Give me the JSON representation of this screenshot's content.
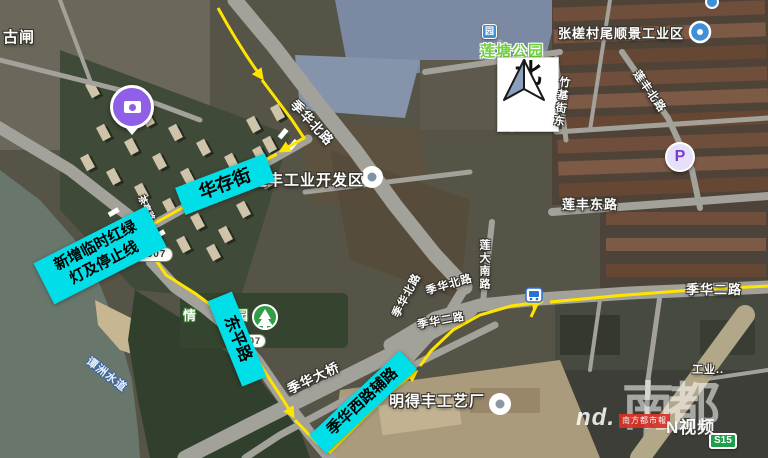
{
  "map_colors": {
    "annotation_bg": "#00dfe8",
    "route_yellow": "#ffe400"
  },
  "annotations": {
    "huacun": "华存街",
    "new_light_l1": "新增临时红绿",
    "new_light_l2": "灯及停止线",
    "dongping": "东平路",
    "jihua_west_aux": "季华西路辅路"
  },
  "roads": {
    "x507": "X507",
    "x507_b": "X507",
    "jihua_north_a": "季华北路",
    "jihua_north_b": "季华北路",
    "jihua_north_c": "季华北路",
    "jihua_second_a": "季华二路",
    "jihua_second_b": "季华二路",
    "chating": "茶亭路",
    "lianfeng_north": "莲丰北路",
    "lianfeng_east": "莲丰东路",
    "lianda_south": "莲大南路",
    "zhuji_east": "竹基街东",
    "jihua_bridge": "季华大桥",
    "s15": "S15"
  },
  "places": {
    "guzha": "古闸",
    "lianfeng_industrial": "莲丰工业开发区",
    "liantang_park": "莲塘公园",
    "park_icon_char": "园",
    "zhangcha_industrial": "张槎村尾顺景工业区",
    "qinglv_left": "情",
    "qinglv_right": "园",
    "mingdefeng": "明得丰工艺厂",
    "tanzhou": "谭洲水道",
    "gongye": "工业..",
    "north": "北",
    "parking": "P"
  },
  "watermark": {
    "brush_a": "南",
    "brush_b": "都",
    "nd": "nd.",
    "press": "南方都市報",
    "nvideo": "N视频"
  }
}
